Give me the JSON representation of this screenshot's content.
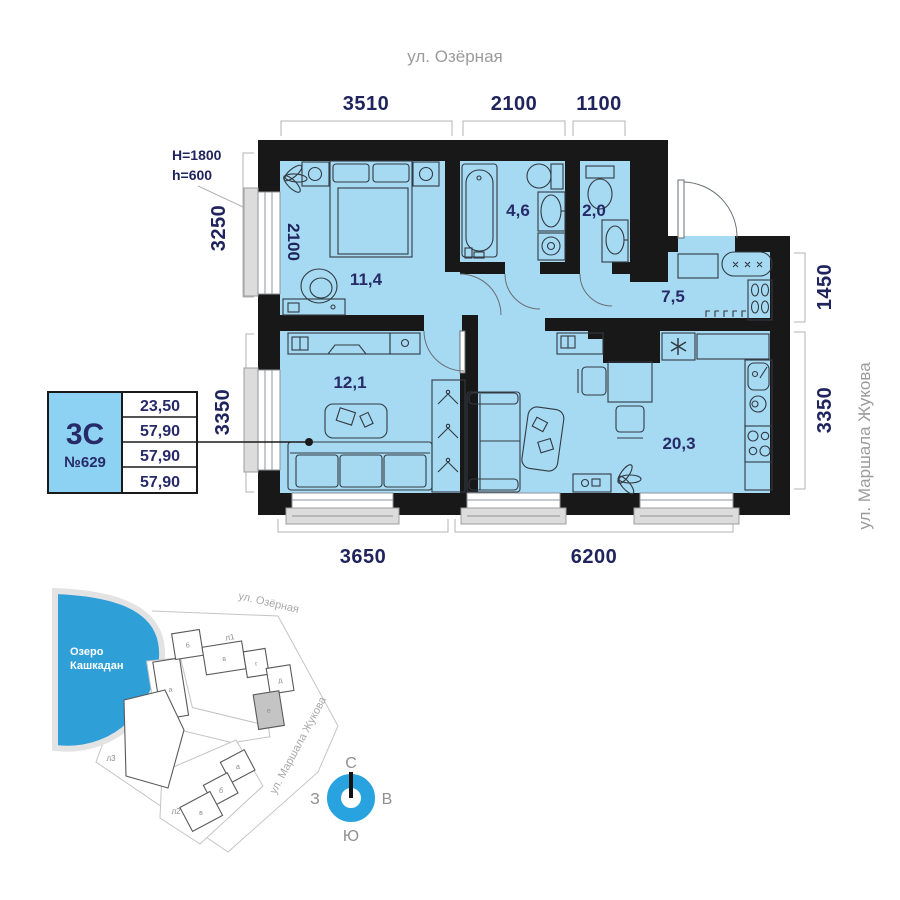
{
  "colors": {
    "room_fill": "#a6d9f2",
    "wall": "#181818",
    "label_navy": "#272a68",
    "dim_navy": "#20245c",
    "street_gray": "#9b9b9b",
    "lake_blue": "#2f9fd8",
    "compass_blue": "#29a3e0",
    "card_cell_blue": "#8ed2f3",
    "highlight_gray": "#c4c4c4"
  },
  "streets": {
    "top": "ул. Озёрная",
    "right": "ул. Маршала Жукова"
  },
  "window_note": {
    "line1": "H=1800",
    "line2": "h=600"
  },
  "dims": {
    "top": [
      "3510",
      "2100",
      "1100"
    ],
    "bottom": [
      "3650",
      "6200"
    ],
    "left_top": "3250",
    "left_bottom": "3350",
    "right_top": "1450",
    "right_bottom": "3350",
    "bedroom_width": "2100"
  },
  "rooms": {
    "bedroom": "11,4",
    "bathroom": "4,6",
    "wc": "2,0",
    "hallway": "7,5",
    "room2": "12,1",
    "living": "20,3"
  },
  "card": {
    "type": "3С",
    "number": "№629",
    "rows": [
      "23,50",
      "57,90",
      "57,90",
      "57,90"
    ]
  },
  "site": {
    "lake_line1": "Озеро",
    "lake_line2": "Кашкадан",
    "street_top": "ул. Озёрная",
    "street_right": "ул. Маршала Жукова",
    "b1": {
      "label": "л1",
      "s": [
        "а",
        "б",
        "в",
        "г",
        "д",
        "е"
      ]
    },
    "b2": {
      "label": "л2",
      "s": [
        "а",
        "б",
        "в"
      ]
    },
    "b3": {
      "label": "л3"
    }
  },
  "compass": {
    "n": "С",
    "e": "В",
    "s": "Ю",
    "w": "З"
  }
}
